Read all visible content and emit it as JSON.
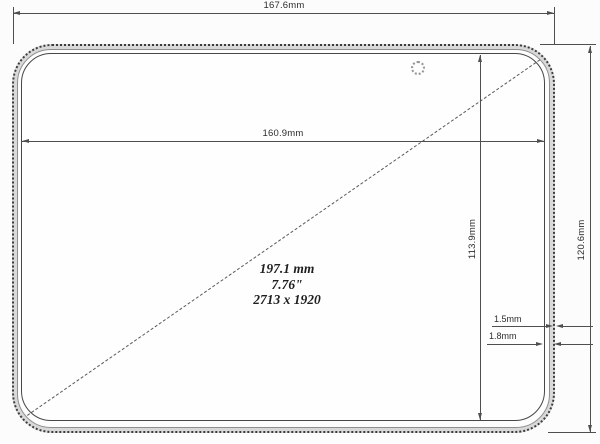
{
  "drawing": {
    "type": "tablet front-panel dimension drawing",
    "labels": {
      "outer_width": "167.6mm",
      "display_width": "160.9mm",
      "display_height": "113.9mm",
      "outer_height": "120.6mm",
      "bezel_rim": "1.5mm",
      "bezel_total": "1.8mm"
    },
    "display": {
      "diagonal_mm": "197.1 mm",
      "diagonal_inch": "7.76\"",
      "resolution": "2713 x 1920"
    },
    "icons": [
      "camera-icon"
    ],
    "colors": {
      "line": "#474747",
      "dim_line": "#4f4f4f",
      "rim_fill": "#d9d9d9",
      "background": "#fcfcfc",
      "text": "#2d2d2d"
    }
  }
}
